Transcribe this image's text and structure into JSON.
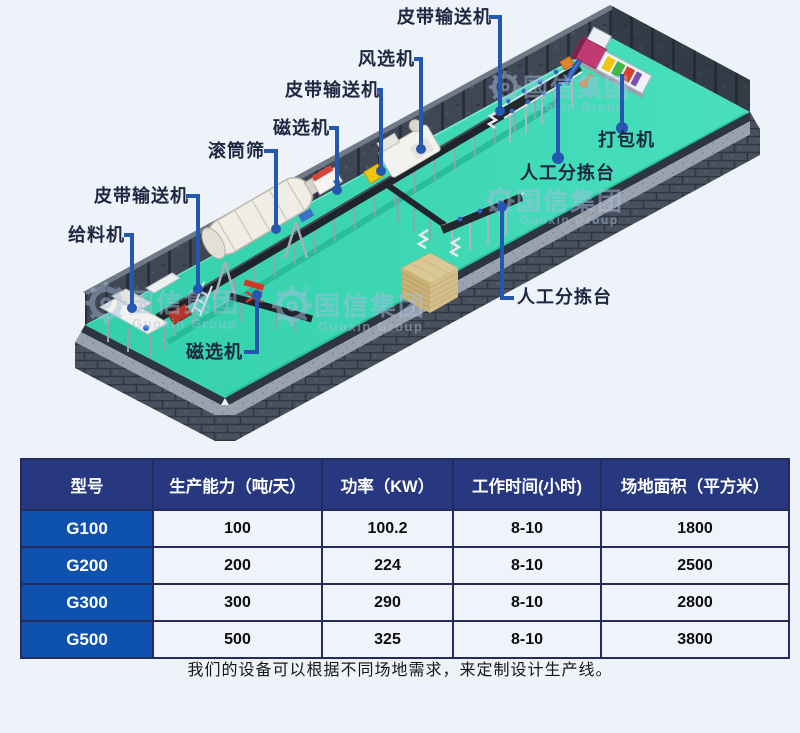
{
  "watermark": {
    "cn": "国信集团",
    "en": "Guoxin Group"
  },
  "diagram": {
    "labels": [
      {
        "id": "feeder",
        "text": "给料机"
      },
      {
        "id": "belt-conveyor-left",
        "text": "皮带输送机"
      },
      {
        "id": "magnet-bottom",
        "text": "磁选机"
      },
      {
        "id": "trommel-screen",
        "text": "滚筒筛"
      },
      {
        "id": "magnet-top",
        "text": "磁选机"
      },
      {
        "id": "belt-conveyor-mid",
        "text": "皮带输送机"
      },
      {
        "id": "wind-separator",
        "text": "风选机"
      },
      {
        "id": "belt-conveyor-top",
        "text": "皮带输送机"
      },
      {
        "id": "sorting-upper",
        "text": "人工分拣台"
      },
      {
        "id": "baler",
        "text": "打包机"
      },
      {
        "id": "sorting-lower",
        "text": "人工分拣台"
      }
    ],
    "colors": {
      "floor": "#3cd8b4",
      "wall": "#3e4753",
      "leader_line": "#2457b0",
      "label_text": "#1c2740"
    }
  },
  "table": {
    "headers": [
      "型号",
      "生产能力（吨/天）",
      "功率（KW）",
      "工作时间(小时)",
      "场地面积（平方米）"
    ],
    "rows": [
      {
        "model": "G100",
        "values": [
          "100",
          "100.2",
          "8-10",
          "1800"
        ]
      },
      {
        "model": "G200",
        "values": [
          "200",
          "224",
          "8-10",
          "2500"
        ]
      },
      {
        "model": "G300",
        "values": [
          "300",
          "290",
          "8-10",
          "2800"
        ]
      },
      {
        "model": "G500",
        "values": [
          "500",
          "325",
          "8-10",
          "3800"
        ]
      }
    ],
    "colors": {
      "header_bg": "#273780",
      "model_bg": "#0e51ae",
      "row_bg": "#f0f3fa",
      "border": "#232c5a"
    }
  },
  "caption": "我们的设备可以根据不同场地需求，来定制设计生产线。"
}
